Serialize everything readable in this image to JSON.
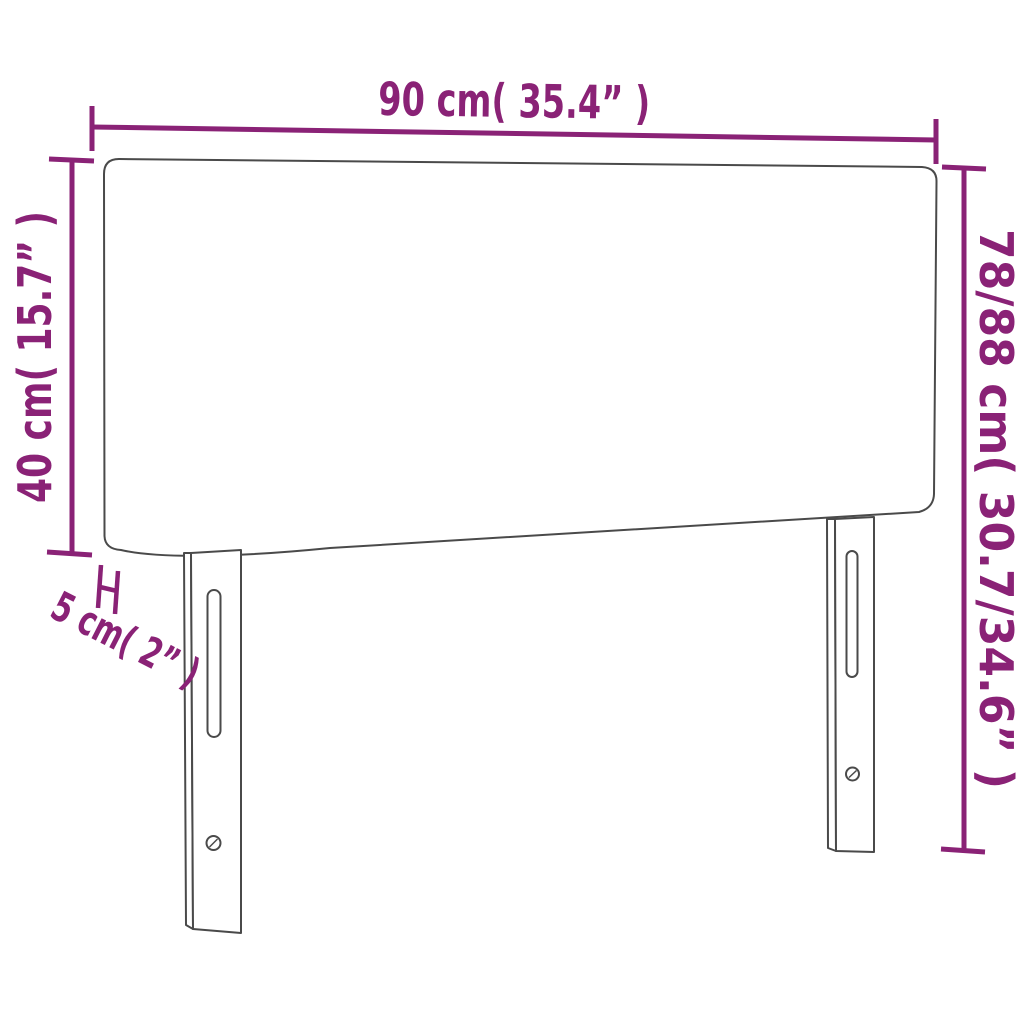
{
  "diagram": {
    "title": "headboard-dimension-diagram",
    "product": "upholstered headboard with two legs",
    "colors": {
      "accent": "#8A2276",
      "outline": "#4A4A4A",
      "background": "#FFFFFF"
    },
    "dimensions": {
      "width": {
        "label": "90 cm( 35.4” )",
        "value_cm": 90,
        "value_in": 35.4
      },
      "panel_height": {
        "label": "40 cm( 15.7” )",
        "value_cm": 40,
        "value_in": 15.7
      },
      "total_height": {
        "label": "78/88 cm( 30.7/34.6” )",
        "value_cm": "78/88",
        "value_in": "30.7/34.6"
      },
      "thickness": {
        "label": "5 cm( 2” )",
        "value_cm": 5,
        "value_in": 2
      }
    }
  }
}
